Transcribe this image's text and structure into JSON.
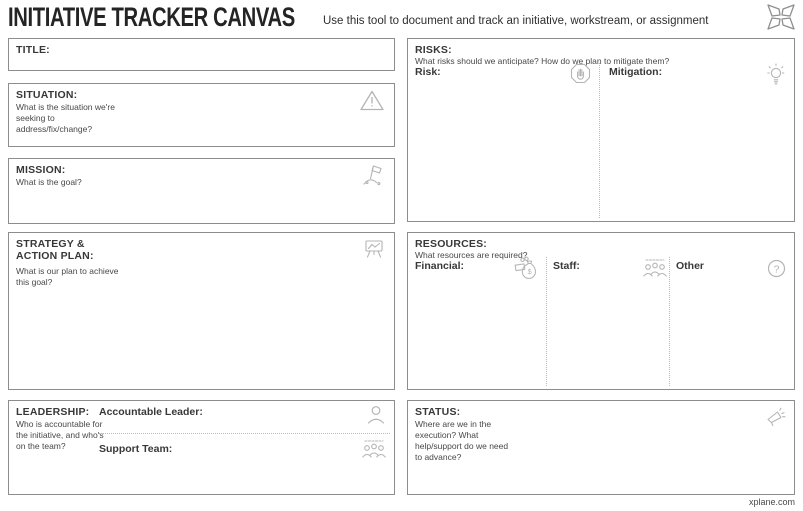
{
  "header": {
    "title": "INITIATIVE TRACKER CANVAS",
    "subtitle": "Use this tool to document and track an initiative, workstream, or assignment",
    "logo_icon": "xplane-x-logo"
  },
  "footer": {
    "link": "xplane.com"
  },
  "colors": {
    "panel_border": "#8d8d8d",
    "icon_gray": "#b4b4b4",
    "dotted_divider": "#b8b8b8",
    "text_dark": "#2e2e2e"
  },
  "panels": {
    "title": {
      "label": "TITLE:"
    },
    "situation": {
      "label": "SITUATION:",
      "description": "What is the situation we're seeking to address/fix/change?",
      "icon": "warning-triangle-icon"
    },
    "mission": {
      "label": "MISSION:",
      "description": "What is the goal?",
      "icon": "flag-on-summit-icon"
    },
    "strategy": {
      "label": "STRATEGY & ACTION PLAN:",
      "description": "What is our plan to achieve this goal?",
      "icon": "chart-easel-icon"
    },
    "leadership": {
      "label": "LEADERSHIP:",
      "description": "Who is accountable for the initiative, and who's on the team?",
      "accountable_leader_label": "Accountable Leader:",
      "accountable_leader_icon": "person-icon",
      "support_team_label": "Support Team:",
      "support_team_icon": "team-icon"
    },
    "risks": {
      "label": "RISKS:",
      "description": "What risks should we anticipate? How do we plan to mitigate them?",
      "risk_label": "Risk:",
      "risk_icon": "stop-hand-icon",
      "mitigation_label": "Mitigation:",
      "mitigation_icon": "lightbulb-icon"
    },
    "resources": {
      "label": "RESOURCES:",
      "description": "What resources are required?",
      "financial_label": "Financial:",
      "financial_icon": "money-bag-icon",
      "staff_label": "Staff:",
      "staff_icon": "team-icon",
      "other_label": "Other",
      "other_icon": "question-circle-icon"
    },
    "status": {
      "label": "STATUS:",
      "description": "Where are we in the execution? What help/support do we need to advance?",
      "icon": "megaphone-icon"
    }
  }
}
